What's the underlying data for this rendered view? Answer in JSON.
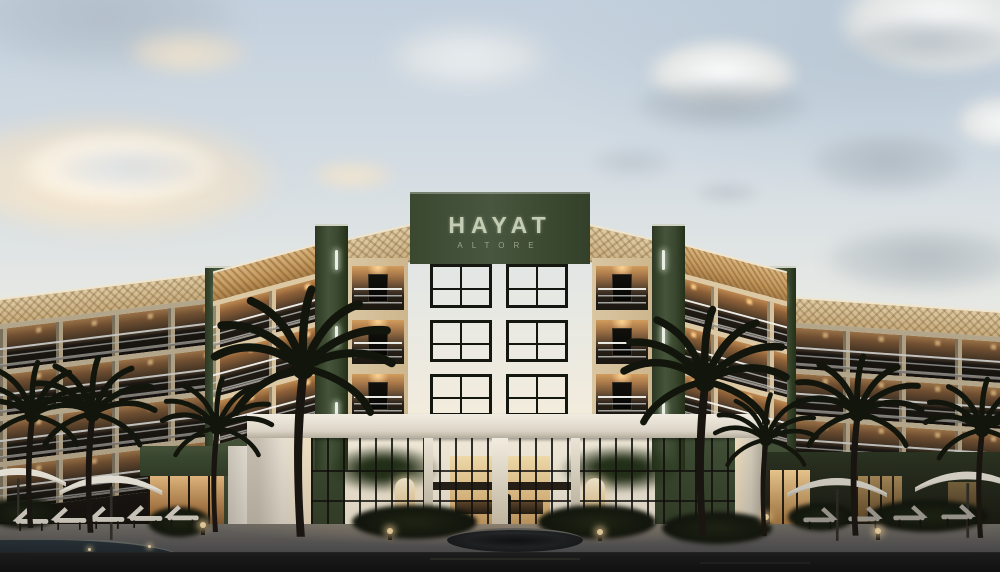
{
  "sign": {
    "title": "HAYAT",
    "subtitle": "ALTORE"
  },
  "palette": {
    "facade_green": "#3d4a31",
    "facade_cream": "#e5d3b3",
    "fascia_gold": "#c89f66",
    "fascia_diamond": "#d9c59d",
    "window_glow": "#eccf9c",
    "sky_top": "#c3d0dd",
    "sky_horizon": "#f9f0de",
    "glass_warm": "#e3b872",
    "plaza_gray": "#6e6d6b",
    "road_dark": "#121518",
    "pool_teal": "#22313a",
    "umbrella_white": "#e9e4d9",
    "sign_text": "#c4cdb3"
  }
}
